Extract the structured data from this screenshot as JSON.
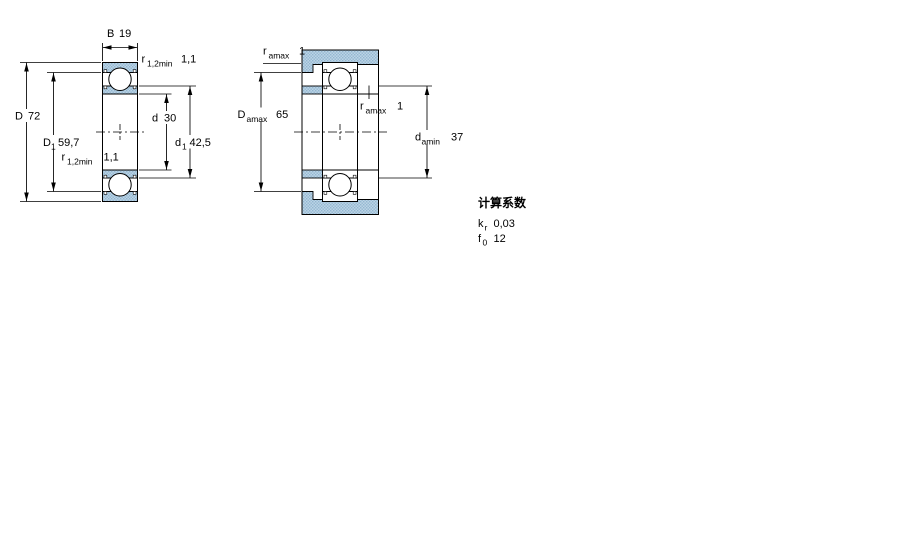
{
  "drawing": {
    "left_view": {
      "description": "deep groove ball bearing cross-section",
      "dim_B": {
        "symbol": "B",
        "value": "19"
      },
      "dim_r12_top": {
        "symbol": "r",
        "subscript": "1,2min",
        "value": "1,1"
      },
      "dim_D": {
        "symbol": "D",
        "value": "72"
      },
      "dim_D1": {
        "symbol": "D",
        "subscript": "1",
        "value": "59,7"
      },
      "dim_r12_bottom": {
        "symbol": "r",
        "subscript": "1,2min",
        "value": "1,1"
      },
      "dim_d": {
        "symbol": "d",
        "value": "30"
      },
      "dim_d1": {
        "symbol": "d",
        "subscript": "1",
        "value": "42,5"
      }
    },
    "right_view": {
      "description": "bearing mounted with shaft and housing abutment dimensions",
      "dim_ra_top": {
        "symbol": "r",
        "subscript": "amax",
        "value": "1"
      },
      "dim_Da": {
        "symbol": "D",
        "subscript": "amax",
        "value": "65"
      },
      "dim_ra_mid": {
        "symbol": "r",
        "subscript": "amax",
        "value": "1"
      },
      "dim_da": {
        "symbol": "d",
        "subscript": "amin",
        "value": "37"
      }
    },
    "calculation_factors": {
      "title": "计算系数",
      "rows": [
        {
          "symbol": "k",
          "subscript": "r",
          "value": "0,03"
        },
        {
          "symbol": "f",
          "subscript": "0",
          "value": "12"
        }
      ]
    },
    "colors": {
      "section_fill": "#bcd4e6",
      "section_dot": "#92b6d0",
      "line": "#000000",
      "background": "#ffffff"
    }
  }
}
